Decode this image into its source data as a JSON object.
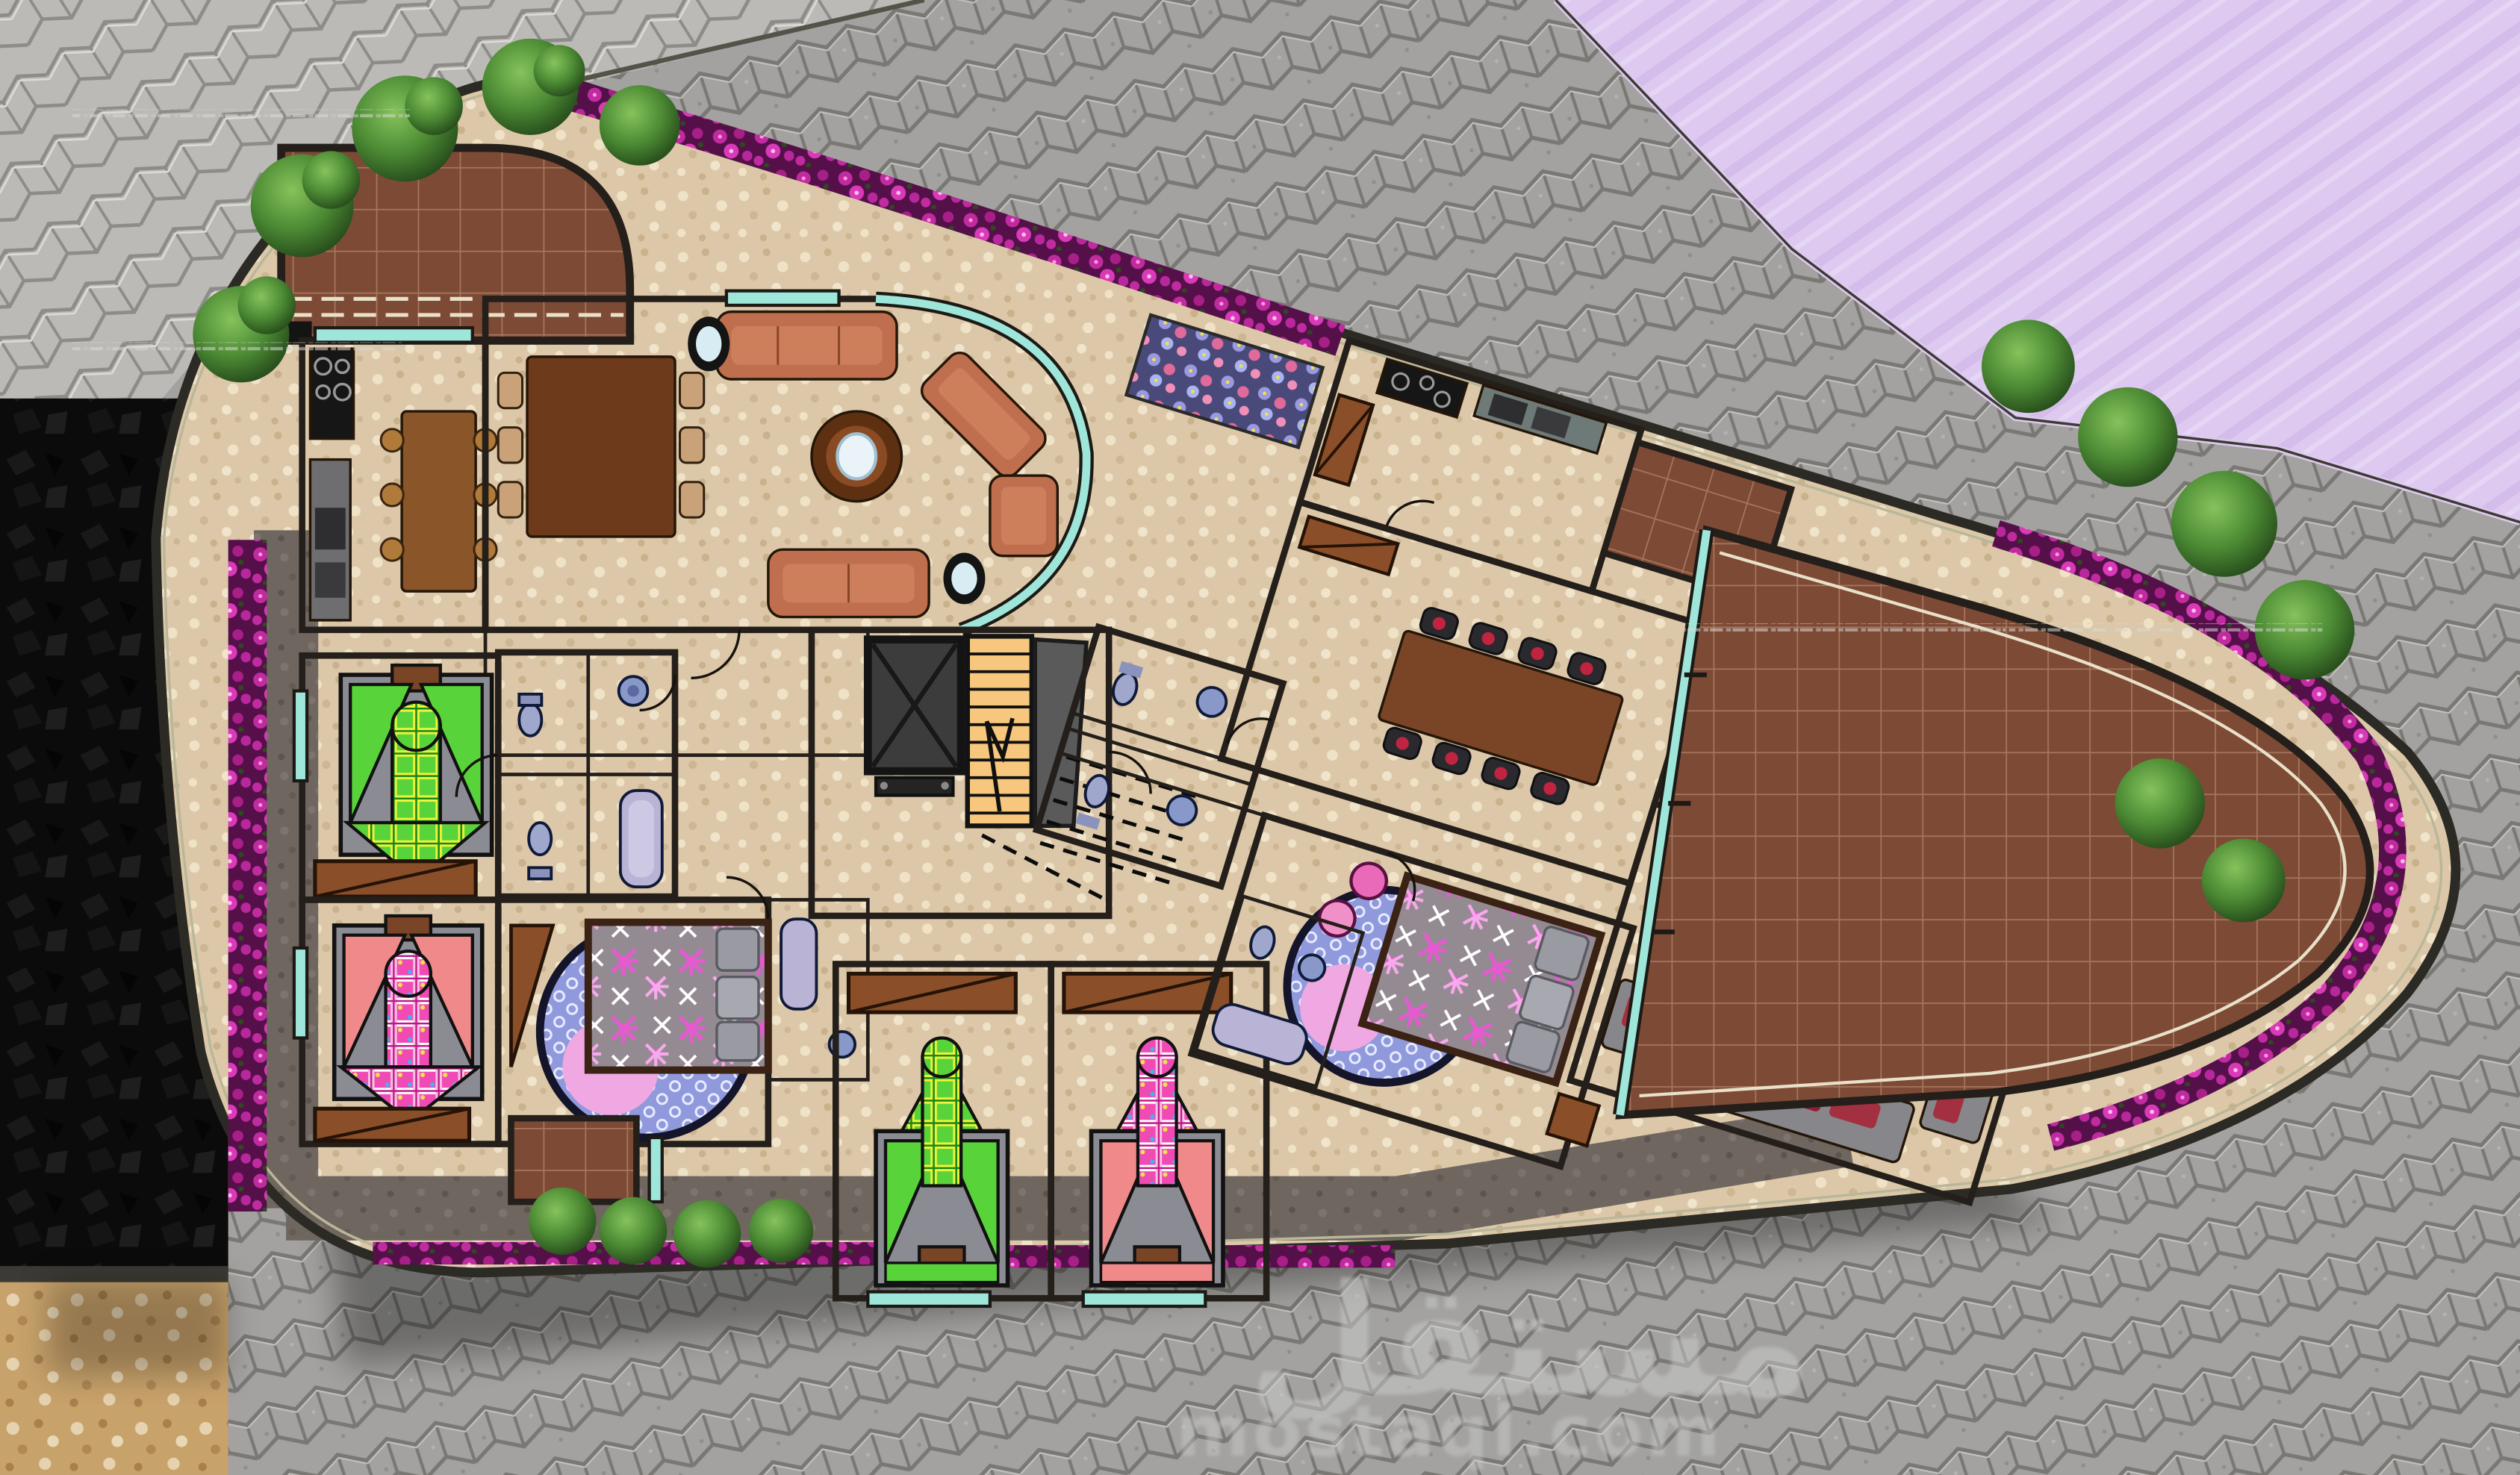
{
  "watermark": {
    "arabic": "مستقل",
    "latin": "mostaql.com"
  },
  "palette": {
    "paver_base": "#a3a2a0",
    "paver_light": "#bcbab6",
    "purple": "#decaf0",
    "walkway_pebble": "#dcc8a8",
    "garden_path": "#6e665f",
    "black_area": "#0b0b0b",
    "terrazzo": "#c8a26b",
    "wood_floor": "#c48e4e",
    "tile_cream": "#f0e8d6",
    "tile_blue": "#c2dde8",
    "tile_brown": "#7d4a36",
    "floor_beige": "#e9d7ae",
    "floor_orange": "#f6c77c",
    "glass": "#9fe6da",
    "sofa_salmon": "#bf6f4e",
    "sofa_gray": "#87878b",
    "flower_magenta": "#b828a0",
    "tree_green": "#3f7a2c",
    "bed_green": "#58d43a",
    "bed_pink": "#f04ab4",
    "watermark_gray": "#cccccc"
  }
}
